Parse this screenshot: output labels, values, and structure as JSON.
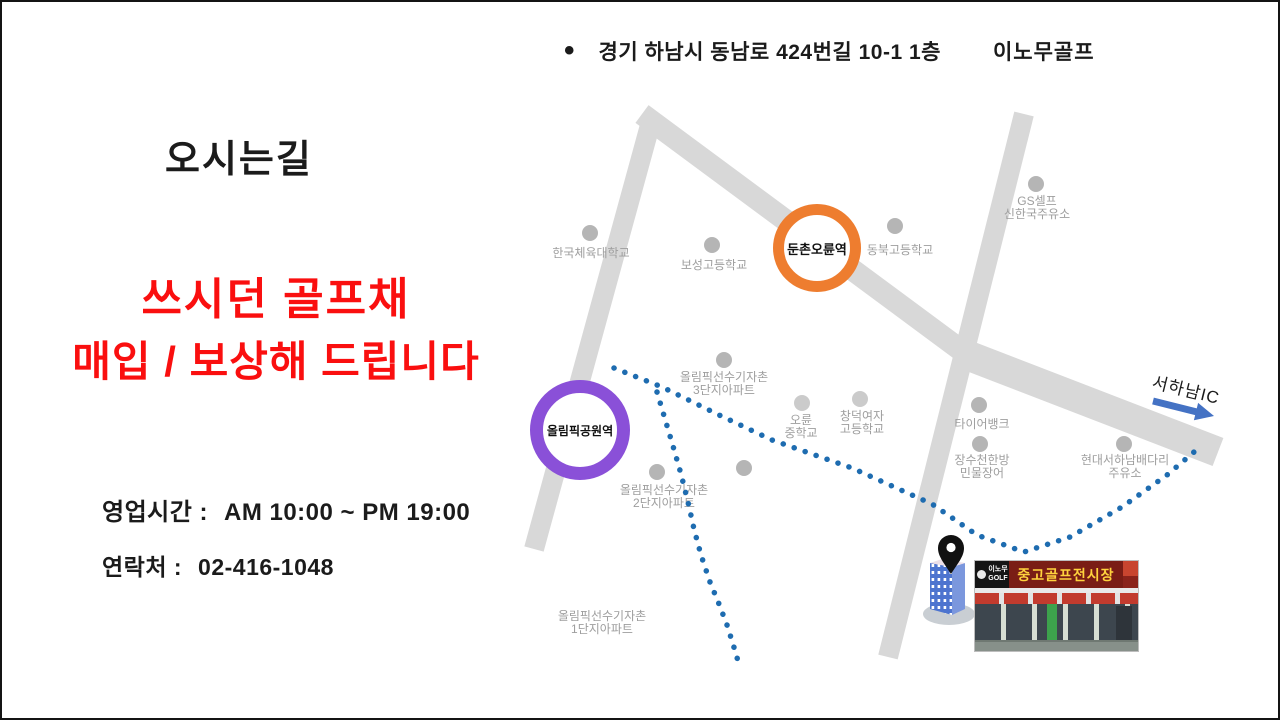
{
  "header": {
    "bullet": "•",
    "address": "경기 하남시 동남로 424번길 10-1 1층",
    "brand": "이노무골프"
  },
  "title": "오시는길",
  "promo": {
    "line1": "쓰시던 골프채",
    "line2": "매입 / 보상해 드립니다",
    "color": "#fa0f0f"
  },
  "info": {
    "hours_label": "영업시간 :",
    "hours_value": "AM 10:00 ~ PM 19:00",
    "contact_label": "연락처 :",
    "contact_value": "02-416-1048"
  },
  "map": {
    "stations": [
      {
        "name": "둔촌오륜역",
        "ring_color": "#ee7d2f"
      },
      {
        "name": "올림픽공원역",
        "ring_color": "#8a50d8"
      }
    ],
    "pois": [
      {
        "line1": "한국체육대학교",
        "line2": ""
      },
      {
        "line1": "보성고등학교",
        "line2": ""
      },
      {
        "line1": "동북고등학교",
        "line2": ""
      },
      {
        "line1": "GS셀프",
        "line2": "신한국주유소"
      },
      {
        "line1": "올림픽선수기자촌",
        "line2": "3단지아파트"
      },
      {
        "line1": "오륜",
        "line2": "중학교"
      },
      {
        "line1": "창덕여자",
        "line2": "고등학교"
      },
      {
        "line1": "타이어뱅크",
        "line2": ""
      },
      {
        "line1": "장수천한방",
        "line2": "민물장어"
      },
      {
        "line1": "현대서하남배다리",
        "line2": "주유소"
      },
      {
        "line1": "올림픽선수기자촌",
        "line2": "2단지아파트"
      },
      {
        "line1": "올림픽선수기자촌",
        "line2": "1단지아파트"
      }
    ],
    "expressway": {
      "label": "서하남IC",
      "arrow_color": "#4472c4"
    },
    "route_style": "blue-dotted"
  },
  "destination": {
    "pin": "location-pin",
    "building": "office-building",
    "store_sign": {
      "brand_line1": "이노무",
      "brand_line2": "GOLF",
      "main": "중고골프전시장"
    }
  },
  "palette": {
    "road": "#d8d8d8",
    "poi_dot": "#b5b5b5",
    "poi_label": "#9e9e9e",
    "route_blue": "#1e6cb0",
    "arrow_blue": "#4472c4",
    "station_orange": "#ee7d2f",
    "station_purple": "#8a50d8",
    "promo_red": "#fa0f0f",
    "store_sign_bg": "#7a1d15",
    "store_sign_text": "#ffd33d"
  }
}
